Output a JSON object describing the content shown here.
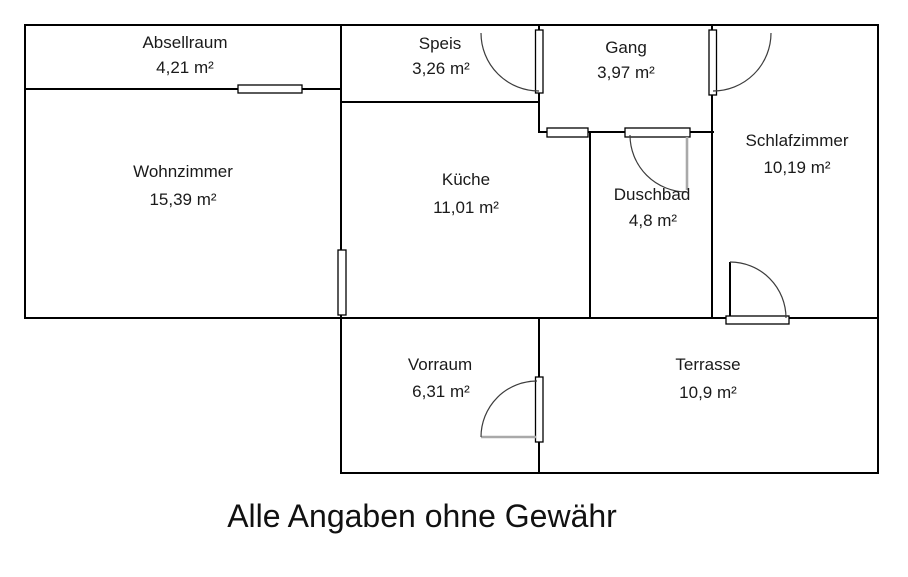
{
  "caption": "Alle Angaben ohne Gewähr",
  "rooms": {
    "absellraum": {
      "name": "Absellraum",
      "area": "4,21 m²"
    },
    "speis": {
      "name": "Speis",
      "area": "3,26 m²"
    },
    "gang": {
      "name": "Gang",
      "area": "3,97 m²"
    },
    "wohnzimmer": {
      "name": "Wohnzimmer",
      "area": "15,39 m²"
    },
    "kueche": {
      "name": "Küche",
      "area": "11,01 m²"
    },
    "duschbad": {
      "name": "Duschbad",
      "area": "4,8 m²"
    },
    "schlafzimmer": {
      "name": "Schlafzimmer",
      "area": "10,19 m²"
    },
    "vorraum": {
      "name": "Vorraum",
      "area": "6,31 m²"
    },
    "terrasse": {
      "name": "Terrasse",
      "area": "10,9 m²"
    }
  },
  "colors": {
    "wall": "#000000",
    "door_leaf_gray": "#a9a9a9",
    "door_arc": "#3c3c3c",
    "text": "#1a1a1a",
    "background": "#ffffff"
  }
}
